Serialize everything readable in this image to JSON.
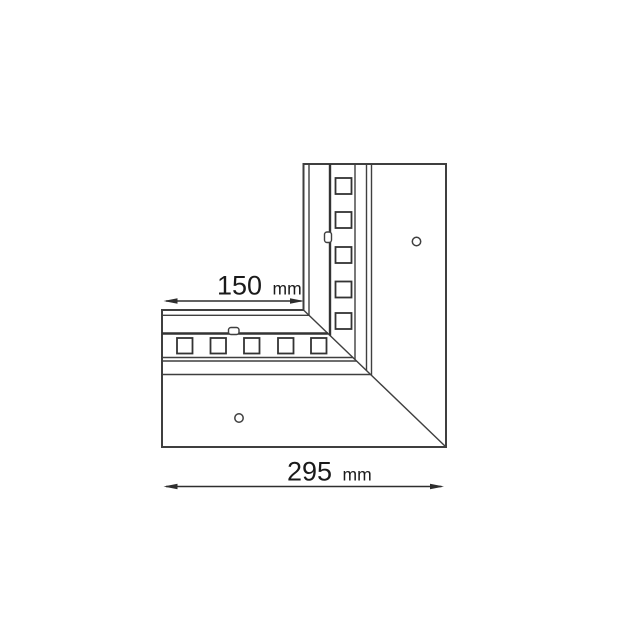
{
  "diagram": {
    "title": "L-shaped corner LED profile technical drawing",
    "view": "top view with mitred corner joint",
    "colors": {
      "background": "#ffffff",
      "line": "#3f3f3f",
      "thick_line": "#333333",
      "text": "#1a1a1a"
    },
    "dimensions": {
      "inner_arm": {
        "value": "150",
        "unit": "mm"
      },
      "outer_width": {
        "value": "295",
        "unit": "mm"
      }
    },
    "vertical_arm": {
      "led_square_count": 5,
      "mounting_hole_count": 1,
      "clip_tab_count": 1
    },
    "horizontal_arm": {
      "led_square_count": 5,
      "mounting_hole_count": 1,
      "clip_tab_count": 1
    }
  }
}
